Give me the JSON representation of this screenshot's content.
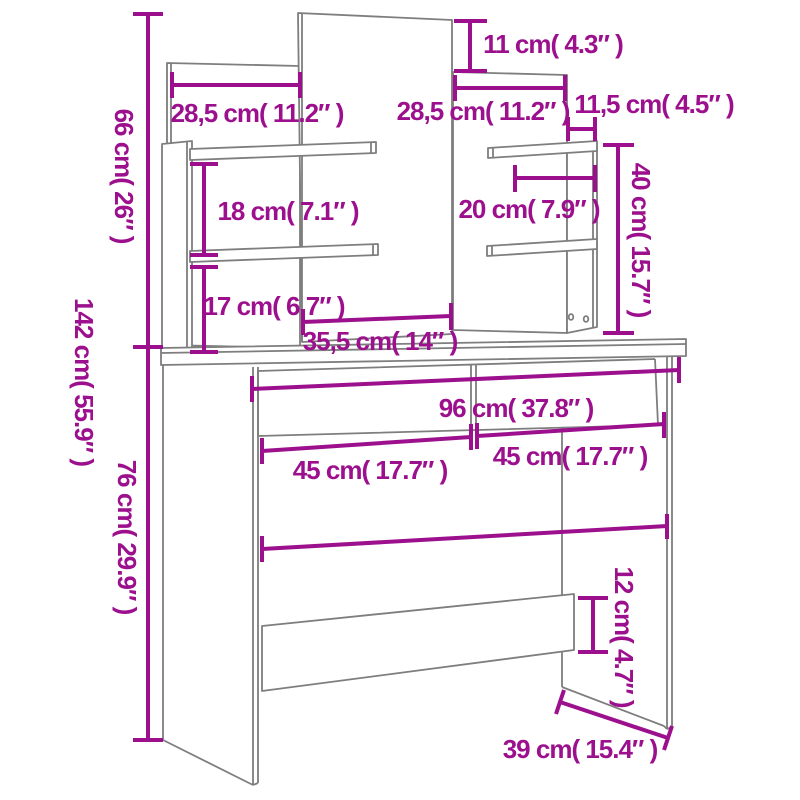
{
  "diagram": {
    "type": "furniture-dimension-diagram",
    "subject": "dressing table with mirror and shelves",
    "units": "cm (inches)"
  },
  "colors": {
    "dimension": "#9c108e",
    "outline": "#7e7e7e",
    "background": "#ffffff"
  },
  "dims": {
    "d11": {
      "label": "11 cm( 4.3″ )"
    },
    "d285L": {
      "label": "28,5 cm( 11.2″ )"
    },
    "d285R": {
      "label": "28,5 cm( 11.2″ )"
    },
    "d115": {
      "label": "11,5 cm( 4.5″ )"
    },
    "d66": {
      "label": "66 cm( 26″ )"
    },
    "d40": {
      "label": "40 cm( 15.7″ )"
    },
    "d18": {
      "label": "18 cm( 7.1″ )"
    },
    "d20": {
      "label": "20 cm( 7.9″ )"
    },
    "d17": {
      "label": "17 cm( 6.7″ )"
    },
    "d142": {
      "label": "142 cm( 55.9″ )"
    },
    "d355": {
      "label": "35,5 cm( 14″ )"
    },
    "d96": {
      "label": "96 cm( 37.8″ )"
    },
    "d45L": {
      "label": "45 cm( 17.7″ )"
    },
    "d45R": {
      "label": "45 cm( 17.7″ )"
    },
    "d76": {
      "label": "76 cm( 29.9″ )"
    },
    "d12": {
      "label": "12 cm( 4.7″ )"
    },
    "d39": {
      "label": "39 cm( 15.4″ )"
    }
  }
}
